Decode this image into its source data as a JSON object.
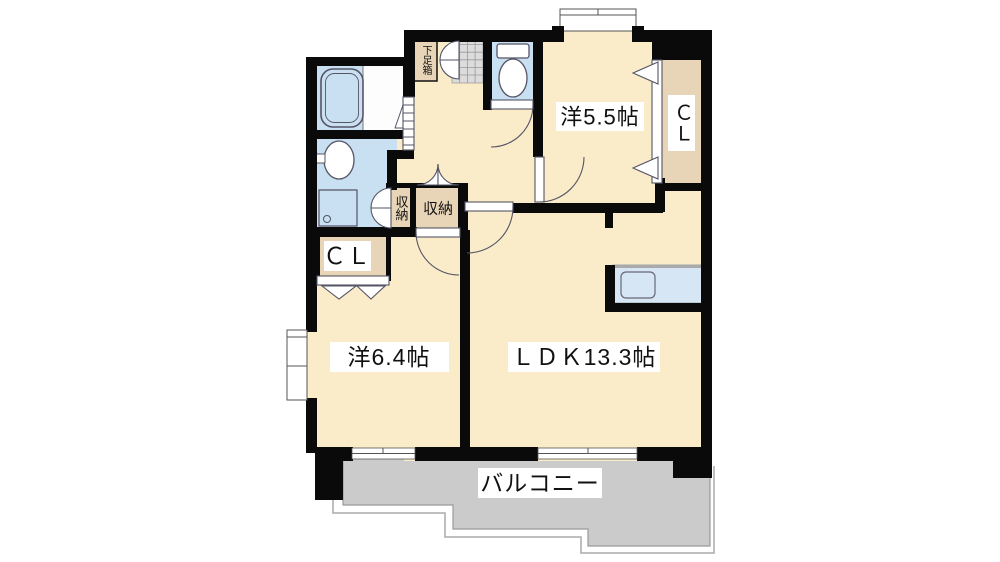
{
  "floorplan": {
    "type": "apartment-floorplan",
    "labels": {
      "bedroom_5_5": "洋5.5帖",
      "bedroom_6_4": "洋6.4帖",
      "ldk": "ＬＤＫ13.3帖",
      "balcony": "バルコニー",
      "closet_right": "ＣＬ",
      "closet_left": "ＣＬ",
      "storage_small": "収納",
      "storage_large": "収納",
      "shoe_box": "下足箱"
    },
    "colors": {
      "room_floor": "#FAEBC9",
      "closet_fill": "#E8D5B8",
      "wet_area": "#C9DFF2",
      "kitchen_counter": "#D6E6F5",
      "balcony": "#CBCBCB",
      "entrance_tile": "#DCDCDC",
      "wall": "#0A0A0A",
      "label_bg": "#FFFFFF"
    }
  }
}
